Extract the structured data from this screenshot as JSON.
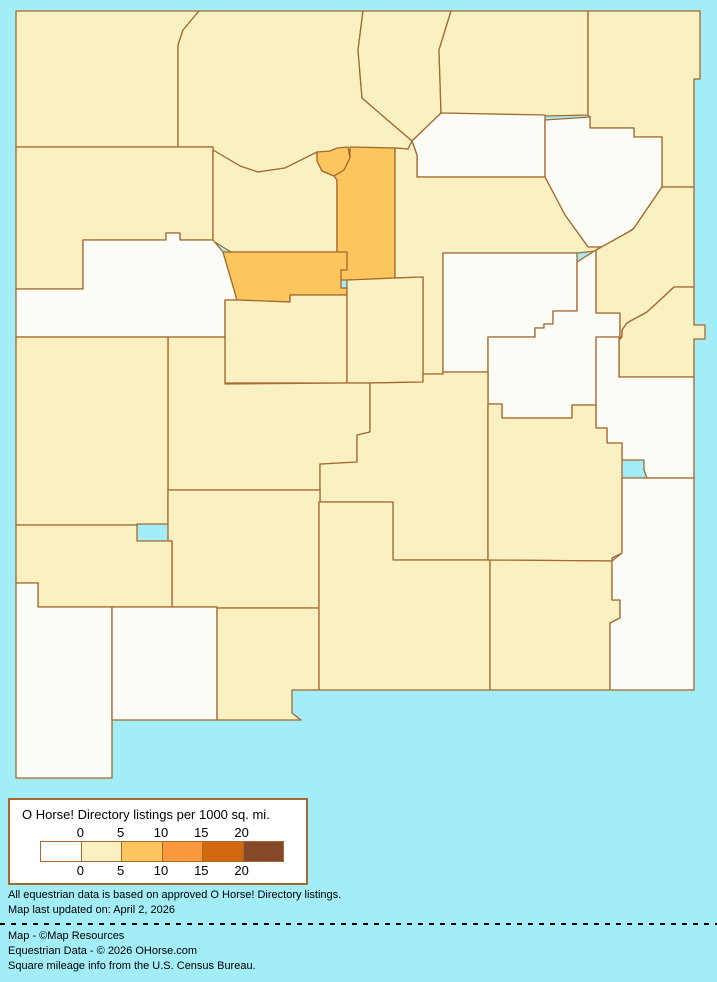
{
  "map": {
    "region": "New Mexico counties",
    "background_color": "#a2edf7",
    "border_color": "#a5682f",
    "bucket_colors": {
      "0": "#fdfdf7",
      "0-5": "#faf1c3",
      "5-10": "#fcc65e"
    },
    "counties": [
      {
        "id": "san-juan",
        "name": "San Juan",
        "value": "0-5",
        "path": "M16,11 L199,11 L183,30 L178,45 L178,147 L16,147 Z"
      },
      {
        "id": "rio-arriba",
        "name": "Rio Arriba",
        "value": "0-5",
        "path": "M199,11 L363,11 L358,50 L362,98 L412,141 L408,149 L395,148 L330,151 L285,168 L258,172 L240,166 L213,150 L213,147 L178,147 L178,45 L183,30 Z"
      },
      {
        "id": "taos",
        "name": "Taos",
        "value": "0-5",
        "path": "M363,11 L451,11 L439,50 L441,113 L412,141 L362,98 L358,50 Z"
      },
      {
        "id": "colfax",
        "name": "Colfax",
        "value": "0-5",
        "path": "M451,11 L588,11 L588,115 L545,116 L441,113 L439,50 Z"
      },
      {
        "id": "union",
        "name": "Union",
        "value": "0-5",
        "path": "M588,11 L700,11 L700,79 L694,79 L694,187 L662,187 L662,137 L634,137 L634,128 L590,128 L590,117 L588,115 Z"
      },
      {
        "id": "mckinley",
        "name": "McKinley",
        "value": "0-5",
        "path": "M16,147 L213,147 L213,240 L180,240 L180,233 L166,233 L166,240 L83,240 L83,289 L16,289 Z"
      },
      {
        "id": "sandoval",
        "name": "Sandoval",
        "value": "0-5",
        "path": "M213,150 L240,166 L258,172 L285,168 L317,152 L317,161 L322,171 L334,176 L337,180 L337,252 L231,252 L213,241 Z"
      },
      {
        "id": "los-alamos",
        "name": "Los Alamos",
        "value": "5-10",
        "path": "M317,152 L330,151 L337,148 L348,147 L350,158 L344,170 L334,176 L322,171 L317,161 Z"
      },
      {
        "id": "santa-fe",
        "name": "Santa Fe",
        "value": "5-10",
        "path": "M350,147 L395,148 L395,278 L390,280 L337,280 L337,180 L334,176 L344,170 L350,158 Z"
      },
      {
        "id": "mora",
        "name": "Mora",
        "value": "0",
        "path": "M441,113 L545,115 L545,177 L417,177 L417,155 L412,141 Z"
      },
      {
        "id": "harding",
        "name": "Harding",
        "value": "0",
        "path": "M545,120 L590,117 L590,128 L634,128 L634,137 L662,137 L662,187 L634,228 L608,247 L588,247 L565,215 L545,177 Z"
      },
      {
        "id": "san-miguel",
        "name": "San Miguel",
        "value": "0-5",
        "path": "M395,148 L408,149 L412,141 L417,155 L417,177 L545,177 L565,215 L588,247 L608,247 L632,230 L596,251 L577,253 L443,253 L443,374 L423,374 L423,277 L395,278 Z"
      },
      {
        "id": "cibola",
        "name": "Cibola",
        "value": "0",
        "path": "M83,240 L166,240 L166,233 L180,233 L180,240 L213,240 L223,252 L237,300 L225,300 L225,337 L16,337 L16,289 L83,289 Z"
      },
      {
        "id": "bernalillo",
        "name": "Bernalillo",
        "value": "5-10",
        "path": "M223,252 L347,252 L347,270 L341,270 L341,288 L347,288 L347,295 L290,295 L290,302 L260,301 L237,300 Z"
      },
      {
        "id": "valencia",
        "name": "Valencia",
        "value": "0-5",
        "path": "M225,300 L237,300 L290,302 L290,295 L347,295 L347,383 L225,383 Z"
      },
      {
        "id": "torrance",
        "name": "Torrance",
        "value": "0-5",
        "path": "M347,280 L395,278 L423,277 L423,382 L370,383 L347,383 Z"
      },
      {
        "id": "guadalupe",
        "name": "Guadalupe",
        "value": "0",
        "path": "M443,253 L577,253 L577,311 L553,311 L553,324 L544,324 L544,328 L535,328 L535,337 L488,337 L488,372 L443,372 Z"
      },
      {
        "id": "de-baca",
        "name": "De Baca",
        "value": "0",
        "path": "M577,262 L596,250 L596,313 L620,313 L620,337 L596,337 L596,405 L572,405 L572,418 L502,418 L502,404 L488,404 L488,337 L535,337 L535,328 L544,328 L544,324 L553,324 L553,311 L577,311 Z"
      },
      {
        "id": "quay",
        "name": "Quay",
        "value": "0-5",
        "path": "M662,187 L694,187 L694,287 L674,287 L658,302 L647,312 L627,323 L622,330 L622,337 L620,337 L620,313 L596,313 L596,250 L632,230 L634,228 Z"
      },
      {
        "id": "curry",
        "name": "Curry",
        "value": "0-5",
        "path": "M674,287 L694,287 L694,325 L705,325 L705,339 L694,339 L694,377 L619,377 L619,340 L622,337 L622,330 L627,323 L647,312 L658,302 Z"
      },
      {
        "id": "roosevelt",
        "name": "Roosevelt",
        "value": "0",
        "path": "M596,337 L619,337 L619,377 L694,377 L694,478 L647,478 L644,470 L644,460 L622,460 L622,443 L607,443 L607,428 L596,428 Z"
      },
      {
        "id": "socorro",
        "name": "Socorro",
        "value": "0-5",
        "path": "M168,337 L225,337 L225,384 L347,383 L370,383 L370,432 L357,435 L357,462 L322,464 L320,464 L320,490 L168,490 Z"
      },
      {
        "id": "catron",
        "name": "Catron",
        "value": "0-5",
        "path": "M16,337 L168,337 L168,524 L137,524 L137,525 L16,525 Z"
      },
      {
        "id": "lincoln",
        "name": "Lincoln",
        "value": "0-5",
        "path": "M370,383 L423,382 L423,374 L443,374 L443,372 L488,372 L488,560 L393,560 L393,502 L320,502 L320,464 L322,464 L357,462 L357,435 L370,432 Z"
      },
      {
        "id": "chaves",
        "name": "Chaves",
        "value": "0-5",
        "path": "M488,404 L502,404 L502,418 L572,418 L572,405 L596,405 L596,428 L607,428 L607,443 L622,443 L622,460 L622,553 L612,558 L612,561 L488,560 Z"
      },
      {
        "id": "sierra",
        "name": "Sierra",
        "value": "0-5",
        "path": "M168,490 L320,490 L320,502 L319,502 L319,608 L217,608 L217,607 L172,607 L172,541 L168,541 Z"
      },
      {
        "id": "grant",
        "name": "Grant",
        "value": "0-5",
        "path": "M16,525 L137,525 L137,541 L172,541 L172,607 L38,607 L38,583 L16,583 Z"
      },
      {
        "id": "hidalgo",
        "name": "Hidalgo",
        "value": "0",
        "path": "M16,583 L38,583 L38,607 L112,607 L112,778 L16,778 Z"
      },
      {
        "id": "luna",
        "name": "Luna",
        "value": "0",
        "path": "M112,607 L217,607 L217,720 L112,720 Z"
      },
      {
        "id": "dona-ana",
        "name": "Dona Ana",
        "value": "0-5",
        "path": "M217,608 L319,608 L319,690 L292,690 L292,713 L301,720 L217,720 Z"
      },
      {
        "id": "otero",
        "name": "Otero",
        "value": "0-5",
        "path": "M319,502 L393,502 L393,560 L490,560 L490,690 L319,690 Z"
      },
      {
        "id": "eddy",
        "name": "Eddy",
        "value": "0-5",
        "path": "M490,560 L612,561 L612,600 L620,600 L620,618 L610,623 L610,690 L490,690 Z"
      },
      {
        "id": "lea",
        "name": "Lea",
        "value": "0",
        "path": "M622,478 L647,478 L694,478 L694,690 L610,690 L610,623 L620,618 L620,600 L612,600 L612,561 L622,553 Z"
      }
    ]
  },
  "legend": {
    "title": "O Horse! Directory listings per 1000 sq. mi.",
    "ticks": [
      "0",
      "5",
      "10",
      "15",
      "20"
    ],
    "swatches": [
      {
        "value": "0",
        "color": "#ffffff"
      },
      {
        "value": "0-5",
        "color": "#faf1c3"
      },
      {
        "value": "5-10",
        "color": "#fcc65e"
      },
      {
        "value": "10-15",
        "color": "#f9993b"
      },
      {
        "value": "15-20",
        "color": "#d2690e"
      },
      {
        "value": "20+",
        "color": "#85492a"
      }
    ]
  },
  "footnotes": [
    "All equestrian data is based on approved O Horse! Directory listings.",
    "Map last updated on: April 2, 2026"
  ],
  "credits": [
    "Map - ©Map Resources",
    "Equestrian Data - © 2026 OHorse.com",
    "Square mileage info from the U.S. Census Bureau."
  ]
}
